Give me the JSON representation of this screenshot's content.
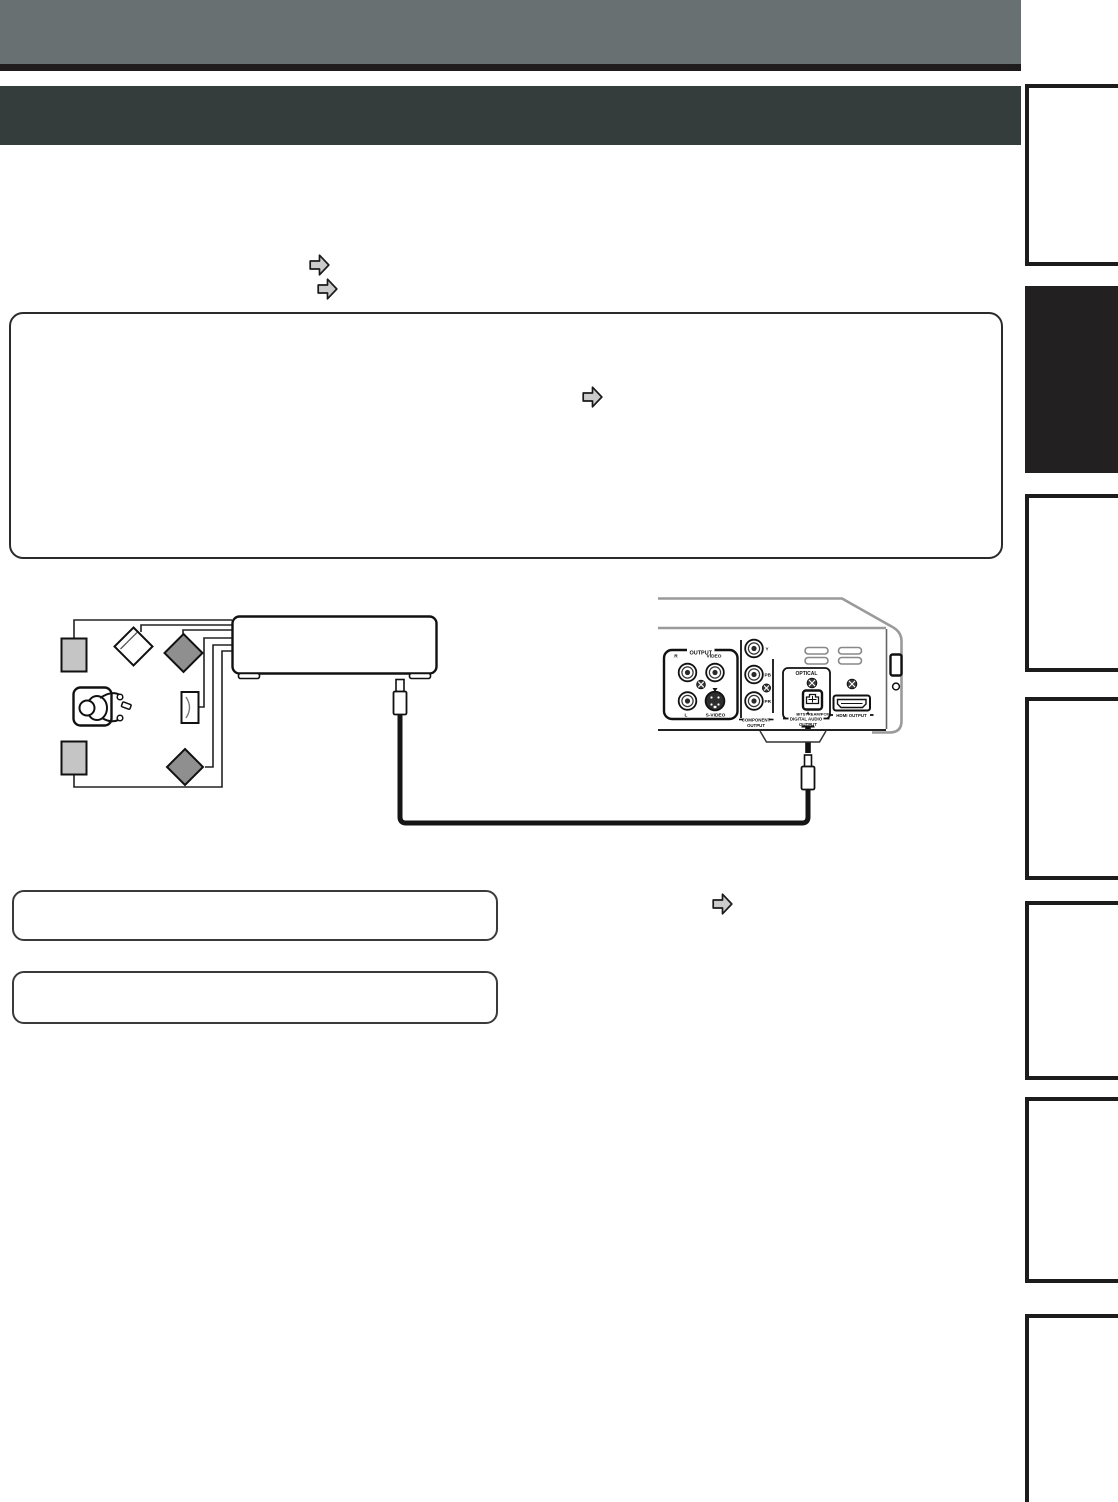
{
  "page": {
    "kind": "owner-manual connection page (instruction text blank/redacted)",
    "colors": {
      "top_bar": "#697072",
      "top_rule": "#201b1d",
      "title_bar": "#343d3c",
      "tab_border": "#1c1c1c",
      "tab_active_fill": "#232021",
      "speaker_light": "#c5c5c5",
      "speaker_dark": "#8f8f8f",
      "arrow_fill": "#cbcbcb",
      "line": "#1a1a1a",
      "panel_contour": "#9a9a9a"
    }
  },
  "header": {
    "title_text": ""
  },
  "note_box": {
    "text": ""
  },
  "callouts": [
    {
      "text": ""
    },
    {
      "text": ""
    }
  ],
  "icons": {
    "ref_arrow": "block-arrow-right",
    "cable_arrow": "arrow-up-solid"
  },
  "sidebar": {
    "tab_count": 7,
    "active_tab_index": 1,
    "tabs": [
      {
        "active": false
      },
      {
        "active": true
      },
      {
        "active": false
      },
      {
        "active": false
      },
      {
        "active": false
      },
      {
        "active": false
      },
      {
        "active": false
      }
    ]
  },
  "rear_panel": {
    "output_group": {
      "label": "OUTPUT",
      "jack_r": "R",
      "jack_video": "VIDEO",
      "jack_l": "L",
      "jack_svideo": "S-VIDEO"
    },
    "component_group": {
      "jack_y": "Y",
      "jack_pb": "PB",
      "jack_pr": "PR",
      "caption_line1": "COMPONENT",
      "caption_line2": "OUTPUT"
    },
    "digital_audio_group": {
      "label": "OPTICAL",
      "caption_line1": "BITSTREAM/PCM",
      "caption_line2": "DIGITAL AUDIO",
      "caption_line3": "OUTPUT"
    },
    "hdmi_group": {
      "label": "HDMI OUTPUT"
    }
  }
}
